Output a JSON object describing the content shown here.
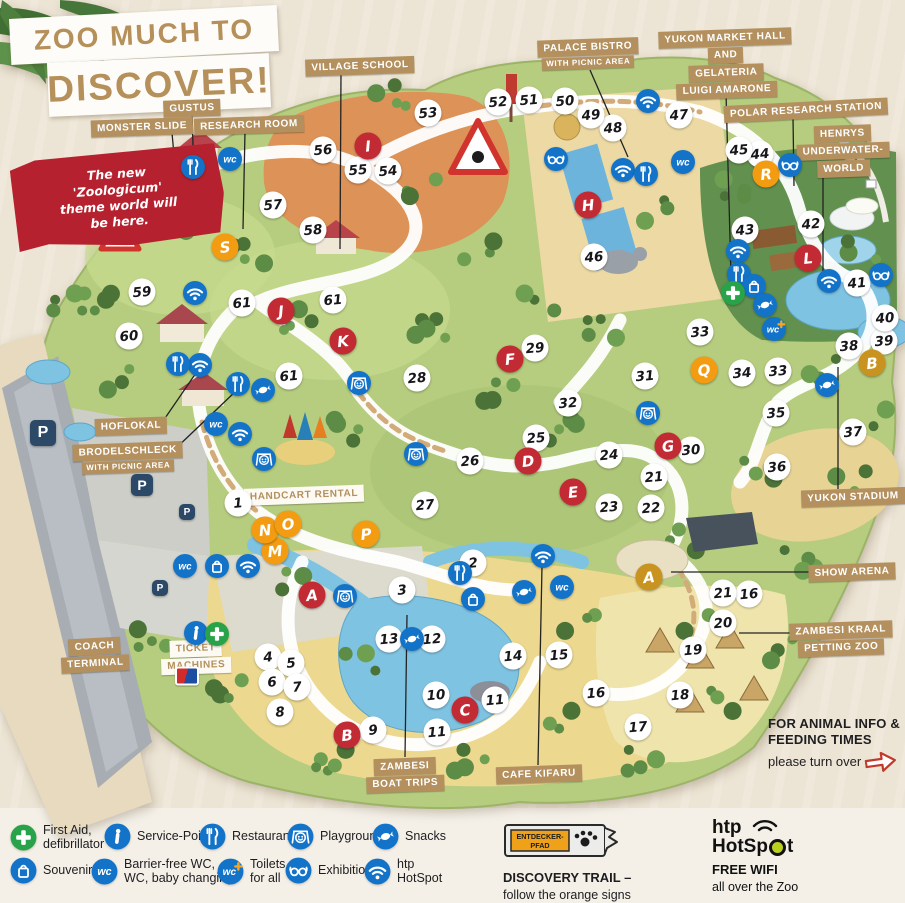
{
  "title": {
    "line1": "ZOO MUCH TO",
    "line2": "DISCOVER!"
  },
  "ribbon": {
    "lines": [
      "The new",
      "'Zoologicum'",
      "theme world will",
      "be here."
    ]
  },
  "animal_info": {
    "line1": "FOR ANIMAL INFO &",
    "line2": "FEEDING TIMES",
    "line3": "please turn over"
  },
  "colors": {
    "red": "#c22b33",
    "orange": "#f39c12",
    "gold": "#c8941f",
    "icon_blue": "#1273c8",
    "label_tan": "#b3905e",
    "ribbon_red": "#b5212e",
    "title_tan": "#b5905a",
    "first_aid_green": "#29a349",
    "trail_orange": "#f0a11a"
  },
  "map": {
    "area_labels": [
      {
        "id": "gustus",
        "lines": [
          "GUSTUS"
        ],
        "cx": 192,
        "cy": 108,
        "rot": -2,
        "line": [
          192,
          114,
          194,
          176
        ]
      },
      {
        "id": "monster-slide",
        "lines": [
          "MONSTER SLIDE"
        ],
        "cx": 142,
        "cy": 127,
        "rot": -2,
        "line": [
          172,
          133,
          181,
          231
        ]
      },
      {
        "id": "research-room",
        "lines": [
          "RESEARCH ROOM"
        ],
        "cx": 249,
        "cy": 125,
        "rot": -2,
        "line": [
          245,
          131,
          243,
          229
        ]
      },
      {
        "id": "village-school",
        "lines": [
          "VILLAGE SCHOOL"
        ],
        "cx": 360,
        "cy": 66,
        "rot": -2,
        "line": [
          341,
          73,
          340,
          249
        ]
      },
      {
        "id": "palace-bistro",
        "lines": [
          "PALACE BISTRO",
          "WITH PICNIC AREA"
        ],
        "small_from": 1,
        "cx": 588,
        "cy": 54,
        "rot": -2,
        "line": [
          590,
          70,
          628,
          157
        ]
      },
      {
        "id": "yukon-market",
        "lines": [
          "YUKON MARKET HALL",
          "AND",
          "GELATERIA",
          "LUIGI AMARONE"
        ],
        "cx": 726,
        "cy": 64,
        "rot": -2,
        "line": [
          726,
          93,
          731,
          275
        ]
      },
      {
        "id": "polar-research",
        "lines": [
          "POLAR RESEARCH STATION"
        ],
        "cx": 806,
        "cy": 110,
        "rot": -3,
        "line": [
          793,
          117,
          794,
          186
        ]
      },
      {
        "id": "henrys",
        "lines": [
          "HENRYS",
          "UNDERWATER-",
          "WORLD"
        ],
        "cx": 843,
        "cy": 151,
        "rot": -2,
        "line": [
          823,
          172,
          823,
          285
        ]
      },
      {
        "id": "hoflokal",
        "lines": [
          "HOFLOKAL"
        ],
        "cx": 131,
        "cy": 426,
        "rot": -2,
        "line": [
          161,
          424,
          196,
          373
        ]
      },
      {
        "id": "brodelschleck",
        "lines": [
          "BRODELSCHLECK",
          "WITH PICNIC AREA"
        ],
        "small_from": 1,
        "cx": 128,
        "cy": 458,
        "rot": -2,
        "line": [
          173,
          451,
          236,
          391
        ]
      },
      {
        "id": "handcart-rental",
        "lines": [
          "HANDCART RENTAL"
        ],
        "variant": "white",
        "cx": 304,
        "cy": 495,
        "rot": -2
      },
      {
        "id": "coach-terminal",
        "lines": [
          "COACH",
          "TERMINAL"
        ],
        "cx": 95,
        "cy": 655,
        "rot": -3
      },
      {
        "id": "ticket-machines",
        "lines": [
          "TICKET",
          "MACHINES"
        ],
        "variant": "white",
        "cx": 196,
        "cy": 657,
        "rot": -2
      },
      {
        "id": "yukon-stadium",
        "lines": [
          "YUKON STADIUM"
        ],
        "cx": 853,
        "cy": 497,
        "rot": -2,
        "line": [
          838,
          489,
          838,
          367
        ]
      },
      {
        "id": "show-arena",
        "lines": [
          "SHOW ARENA"
        ],
        "cx": 852,
        "cy": 572,
        "rot": -2,
        "line": [
          816,
          572,
          671,
          572
        ]
      },
      {
        "id": "zambesi-kraal",
        "lines": [
          "ZAMBESI KRAAL",
          "PETTING ZOO"
        ],
        "cx": 841,
        "cy": 639,
        "rot": -2,
        "line": [
          803,
          633,
          739,
          633
        ]
      },
      {
        "id": "zambesi-boat-trips",
        "lines": [
          "ZAMBESI",
          "BOAT TRIPS"
        ],
        "cx": 405,
        "cy": 775,
        "rot": -2,
        "line": [
          405,
          757,
          407,
          615
        ]
      },
      {
        "id": "cafe-kifaru",
        "lines": [
          "CAFE KIFARU"
        ],
        "cx": 539,
        "cy": 774,
        "rot": -2,
        "line": [
          538,
          765,
          542,
          566
        ]
      }
    ],
    "numbers": [
      {
        "n": 1,
        "x": 238,
        "y": 503
      },
      {
        "n": 2,
        "x": 473,
        "y": 563
      },
      {
        "n": 3,
        "x": 402,
        "y": 590
      },
      {
        "n": 4,
        "x": 268,
        "y": 657
      },
      {
        "n": 5,
        "x": 291,
        "y": 663
      },
      {
        "n": 6,
        "x": 272,
        "y": 682
      },
      {
        "n": 7,
        "x": 297,
        "y": 687
      },
      {
        "n": 8,
        "x": 280,
        "y": 712
      },
      {
        "n": 9,
        "x": 373,
        "y": 730
      },
      {
        "n": 10,
        "x": 436,
        "y": 695
      },
      {
        "n": 11,
        "x": 495,
        "y": 700
      },
      {
        "n": 11,
        "x": 437,
        "y": 732
      },
      {
        "n": 12,
        "x": 432,
        "y": 639
      },
      {
        "n": 13,
        "x": 389,
        "y": 639
      },
      {
        "n": 14,
        "x": 513,
        "y": 656
      },
      {
        "n": 15,
        "x": 559,
        "y": 655
      },
      {
        "n": 16,
        "x": 749,
        "y": 594
      },
      {
        "n": 16,
        "x": 596,
        "y": 693
      },
      {
        "n": 17,
        "x": 638,
        "y": 727
      },
      {
        "n": 18,
        "x": 680,
        "y": 695
      },
      {
        "n": 19,
        "x": 693,
        "y": 650
      },
      {
        "n": 20,
        "x": 723,
        "y": 623
      },
      {
        "n": 21,
        "x": 654,
        "y": 477
      },
      {
        "n": 21,
        "x": 723,
        "y": 593
      },
      {
        "n": 22,
        "x": 651,
        "y": 508
      },
      {
        "n": 23,
        "x": 609,
        "y": 507
      },
      {
        "n": 24,
        "x": 609,
        "y": 455
      },
      {
        "n": 25,
        "x": 536,
        "y": 438
      },
      {
        "n": 26,
        "x": 470,
        "y": 461
      },
      {
        "n": 27,
        "x": 425,
        "y": 505
      },
      {
        "n": 28,
        "x": 417,
        "y": 378
      },
      {
        "n": 29,
        "x": 535,
        "y": 348
      },
      {
        "n": 30,
        "x": 691,
        "y": 450
      },
      {
        "n": 31,
        "x": 645,
        "y": 376
      },
      {
        "n": 32,
        "x": 568,
        "y": 403
      },
      {
        "n": 33,
        "x": 700,
        "y": 332
      },
      {
        "n": 33,
        "x": 778,
        "y": 371
      },
      {
        "n": 34,
        "x": 742,
        "y": 373
      },
      {
        "n": 35,
        "x": 776,
        "y": 413
      },
      {
        "n": 36,
        "x": 777,
        "y": 467
      },
      {
        "n": 37,
        "x": 853,
        "y": 432
      },
      {
        "n": 38,
        "x": 849,
        "y": 346
      },
      {
        "n": 39,
        "x": 884,
        "y": 341
      },
      {
        "n": 40,
        "x": 885,
        "y": 318
      },
      {
        "n": 41,
        "x": 857,
        "y": 283
      },
      {
        "n": 42,
        "x": 811,
        "y": 224
      },
      {
        "n": 43,
        "x": 745,
        "y": 230
      },
      {
        "n": 44,
        "x": 760,
        "y": 154
      },
      {
        "n": 45,
        "x": 739,
        "y": 150
      },
      {
        "n": 46,
        "x": 594,
        "y": 257
      },
      {
        "n": 47,
        "x": 679,
        "y": 115
      },
      {
        "n": 48,
        "x": 613,
        "y": 128
      },
      {
        "n": 49,
        "x": 591,
        "y": 115
      },
      {
        "n": 50,
        "x": 565,
        "y": 101
      },
      {
        "n": 51,
        "x": 529,
        "y": 100
      },
      {
        "n": 52,
        "x": 498,
        "y": 102
      },
      {
        "n": 53,
        "x": 428,
        "y": 113
      },
      {
        "n": 54,
        "x": 388,
        "y": 171
      },
      {
        "n": 55,
        "x": 358,
        "y": 170
      },
      {
        "n": 56,
        "x": 323,
        "y": 150
      },
      {
        "n": 57,
        "x": 273,
        "y": 205
      },
      {
        "n": 58,
        "x": 313,
        "y": 230
      },
      {
        "n": 59,
        "x": 142,
        "y": 292
      },
      {
        "n": 60,
        "x": 129,
        "y": 336
      },
      {
        "n": 61,
        "x": 242,
        "y": 303
      },
      {
        "n": 61,
        "x": 333,
        "y": 300
      },
      {
        "n": 61,
        "x": 289,
        "y": 376
      }
    ],
    "letters": [
      {
        "ch": "A",
        "c": "red",
        "x": 312,
        "y": 595
      },
      {
        "ch": "B",
        "c": "red",
        "x": 347,
        "y": 735
      },
      {
        "ch": "C",
        "c": "red",
        "x": 465,
        "y": 710
      },
      {
        "ch": "D",
        "c": "red",
        "x": 528,
        "y": 461
      },
      {
        "ch": "E",
        "c": "red",
        "x": 573,
        "y": 492
      },
      {
        "ch": "F",
        "c": "red",
        "x": 510,
        "y": 359
      },
      {
        "ch": "G",
        "c": "red",
        "x": 668,
        "y": 446
      },
      {
        "ch": "H",
        "c": "red",
        "x": 588,
        "y": 205
      },
      {
        "ch": "I",
        "c": "red",
        "x": 368,
        "y": 146
      },
      {
        "ch": "J",
        "c": "red",
        "x": 281,
        "y": 311
      },
      {
        "ch": "K",
        "c": "red",
        "x": 343,
        "y": 341
      },
      {
        "ch": "L",
        "c": "red",
        "x": 808,
        "y": 258
      },
      {
        "ch": "M",
        "c": "orange",
        "x": 275,
        "y": 551
      },
      {
        "ch": "N",
        "c": "orange",
        "x": 265,
        "y": 530
      },
      {
        "ch": "O",
        "c": "orange",
        "x": 288,
        "y": 524
      },
      {
        "ch": "P",
        "c": "orange",
        "x": 366,
        "y": 534
      },
      {
        "ch": "Q",
        "c": "orange",
        "x": 704,
        "y": 370
      },
      {
        "ch": "R",
        "c": "orange",
        "x": 766,
        "y": 174
      },
      {
        "ch": "S",
        "c": "orange",
        "x": 225,
        "y": 247
      },
      {
        "ch": "A",
        "c": "gold",
        "x": 649,
        "y": 577
      },
      {
        "ch": "B",
        "c": "gold",
        "x": 872,
        "y": 363
      }
    ],
    "icons": [
      {
        "t": "wifi",
        "x": 195,
        "y": 293
      },
      {
        "t": "wifi",
        "x": 200,
        "y": 365
      },
      {
        "t": "wifi",
        "x": 240,
        "y": 434
      },
      {
        "t": "wifi",
        "x": 543,
        "y": 556
      },
      {
        "t": "wifi",
        "x": 648,
        "y": 101
      },
      {
        "t": "wifi",
        "x": 623,
        "y": 170
      },
      {
        "t": "wifi",
        "x": 738,
        "y": 251
      },
      {
        "t": "wifi",
        "x": 829,
        "y": 281
      },
      {
        "t": "wifi",
        "x": 248,
        "y": 566
      },
      {
        "t": "restaurant",
        "x": 193,
        "y": 167
      },
      {
        "t": "restaurant",
        "x": 178,
        "y": 364
      },
      {
        "t": "restaurant",
        "x": 238,
        "y": 384
      },
      {
        "t": "restaurant",
        "x": 646,
        "y": 174
      },
      {
        "t": "restaurant",
        "x": 739,
        "y": 274
      },
      {
        "t": "restaurant",
        "x": 460,
        "y": 573
      },
      {
        "t": "wc",
        "x": 230,
        "y": 159
      },
      {
        "t": "wc",
        "x": 216,
        "y": 424
      },
      {
        "t": "wc",
        "x": 185,
        "y": 566
      },
      {
        "t": "wc",
        "x": 683,
        "y": 162
      },
      {
        "t": "wc",
        "x": 562,
        "y": 587
      },
      {
        "t": "wc-plus",
        "x": 774,
        "y": 329
      },
      {
        "t": "souvenirs",
        "x": 217,
        "y": 566
      },
      {
        "t": "souvenirs",
        "x": 754,
        "y": 286
      },
      {
        "t": "souvenirs",
        "x": 473,
        "y": 599
      },
      {
        "t": "snacks",
        "x": 263,
        "y": 390
      },
      {
        "t": "snacks",
        "x": 765,
        "y": 305
      },
      {
        "t": "snacks",
        "x": 827,
        "y": 385
      },
      {
        "t": "snacks",
        "x": 524,
        "y": 592
      },
      {
        "t": "snacks",
        "x": 412,
        "y": 639
      },
      {
        "t": "exhibition",
        "x": 556,
        "y": 159
      },
      {
        "t": "exhibition",
        "x": 790,
        "y": 165
      },
      {
        "t": "exhibition",
        "x": 881,
        "y": 275
      },
      {
        "t": "playground",
        "x": 264,
        "y": 459
      },
      {
        "t": "playground",
        "x": 359,
        "y": 383
      },
      {
        "t": "playground",
        "x": 416,
        "y": 454
      },
      {
        "t": "playground",
        "x": 648,
        "y": 413
      },
      {
        "t": "playground",
        "x": 345,
        "y": 596
      },
      {
        "t": "service",
        "x": 196,
        "y": 633
      },
      {
        "t": "first-aid",
        "x": 217,
        "y": 634
      },
      {
        "t": "first-aid",
        "x": 733,
        "y": 293
      }
    ],
    "parking": {
      "label": "P",
      "spots": [
        {
          "x": 43,
          "y": 433,
          "s": 26
        },
        {
          "x": 142,
          "y": 485,
          "s": 22
        },
        {
          "x": 187,
          "y": 512,
          "s": 16
        },
        {
          "x": 160,
          "y": 588,
          "s": 16
        }
      ]
    },
    "ec_logo": {
      "x": 187,
      "y": 676
    }
  },
  "legend": {
    "items": [
      {
        "icon": "first-aid",
        "x": 10,
        "y": 823,
        "lines": [
          "First Aid,",
          "defibrillator"
        ]
      },
      {
        "icon": "service",
        "x": 104,
        "y": 823,
        "lines": [
          "Service-Point"
        ]
      },
      {
        "icon": "restaurant",
        "x": 199,
        "y": 823,
        "lines": [
          "Restaurant"
        ]
      },
      {
        "icon": "playground",
        "x": 287,
        "y": 823,
        "lines": [
          "Playground"
        ]
      },
      {
        "icon": "snacks",
        "x": 372,
        "y": 823,
        "lines": [
          "Snacks"
        ]
      },
      {
        "icon": "souvenirs",
        "x": 10,
        "y": 857,
        "lines": [
          "Souvenirs"
        ]
      },
      {
        "icon": "wc",
        "x": 91,
        "y": 857,
        "lines": [
          "Barrier-free WC,",
          "WC, baby changing"
        ]
      },
      {
        "icon": "wc-plus",
        "x": 217,
        "y": 857,
        "lines": [
          "Toilets",
          "for all"
        ]
      },
      {
        "icon": "exhibition",
        "x": 285,
        "y": 857,
        "lines": [
          "Exhibition"
        ]
      },
      {
        "icon": "wifi",
        "x": 364,
        "y": 857,
        "lines": [
          "htp",
          "HotSpot"
        ]
      }
    ],
    "discovery": {
      "sign_line1": "ENTDECKER-",
      "sign_line2": "PFAD",
      "title": "DISCOVERY TRAIL –",
      "subtitle": "follow the orange signs"
    },
    "hotspot": {
      "brand_top": "htp",
      "brand_bottom": "HotSpot",
      "title": "FREE WIFI",
      "subtitle": "all over the Zoo"
    }
  }
}
